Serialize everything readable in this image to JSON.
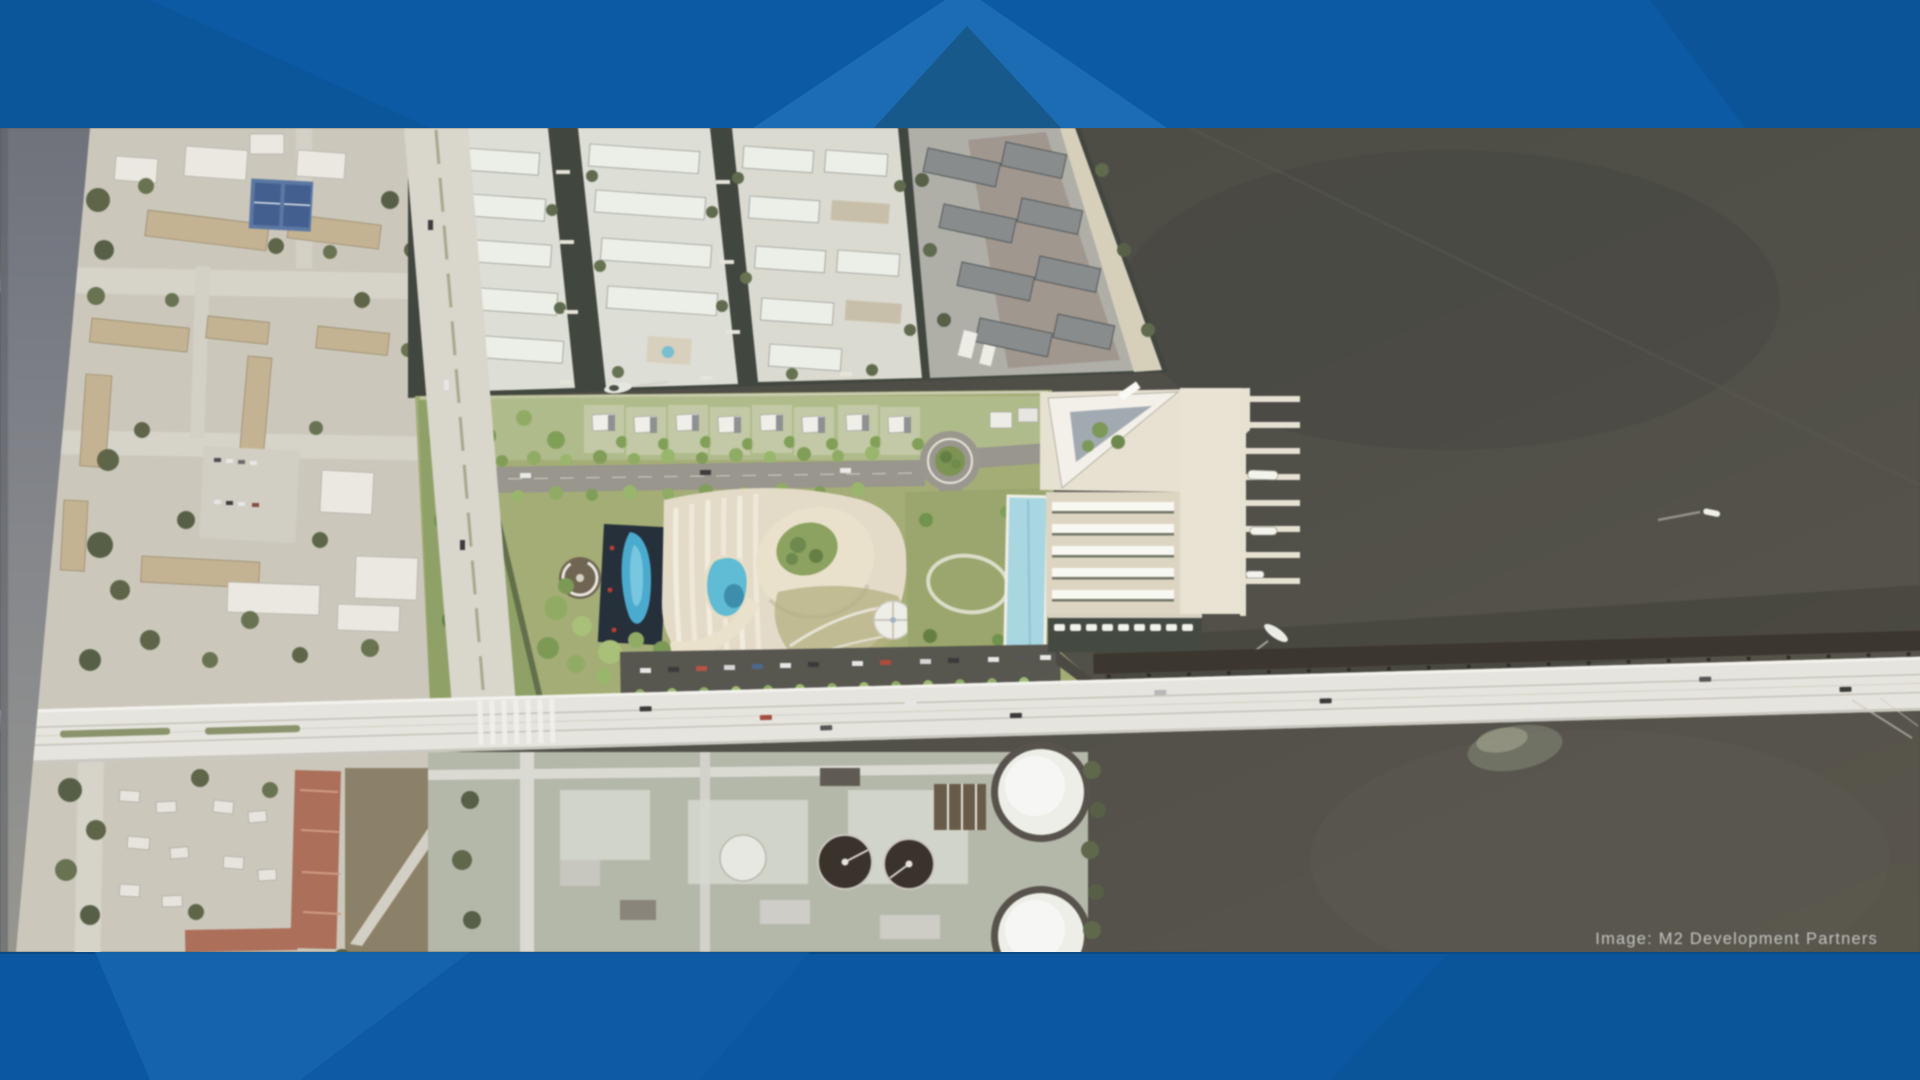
{
  "credit": {
    "text": "Image: M2 Development Partners"
  },
  "frame": {
    "top_bar_color": "#0c59a4",
    "bottom_bar_color": "#0b57a0",
    "chevron_light_color": "#1c6cb3",
    "chevron_dark_color": "#17598a",
    "side_glare_color": "#7d8089",
    "credit_text_color": "#cbcbcb"
  }
}
